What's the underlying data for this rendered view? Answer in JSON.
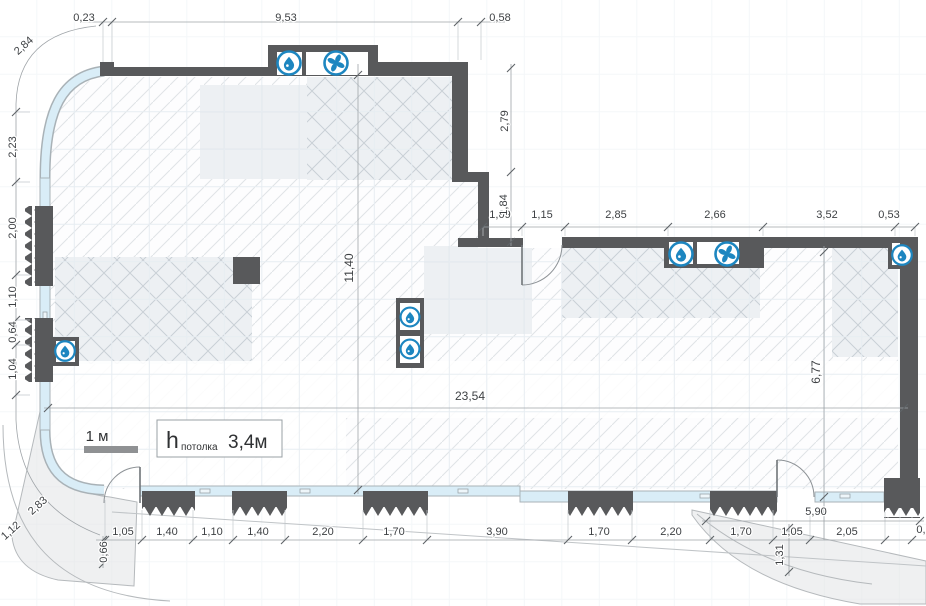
{
  "drawing": {
    "type": "architectural-floor-plan",
    "units": "meters",
    "scale_bar": {
      "label": "1 м"
    },
    "ceiling_height": {
      "symbol": "h",
      "subscript": "потолка",
      "value": "3,4м"
    },
    "colors": {
      "wall": "#58595b",
      "window_glass": "#d9edf7",
      "icon_blue": "#1d86c0",
      "dim_text": "#3e4144"
    },
    "dimensions": {
      "top_chain": [
        "0,23",
        "9,53",
        "0,58"
      ],
      "top_left_arc": "2,84",
      "right_wing_top_chain": [
        "1,09",
        "1,15",
        "2,85",
        "2,66",
        "3,52",
        "0,53"
      ],
      "right_side_verticals": [
        "2,79",
        "1,84"
      ],
      "interior_width": "23,54",
      "interior_height": "11,40",
      "right_wing_depth": "6,77",
      "left_chain": [
        "2,23",
        "2,00",
        "1,10",
        "0,64",
        "1,04"
      ],
      "left_bottom_arc": [
        "2,83",
        "1,12"
      ],
      "bottom_chain": [
        "1,05",
        "1,40",
        "1,10",
        "1,40",
        "2,20",
        "1,70",
        "3,90",
        "1,70",
        "2,20",
        "1,70",
        "1,05",
        "2,05",
        "0,"
      ],
      "bottom_right_overall": "5,90",
      "bottom_left_offset": "0,66",
      "terrace_depth": "1,31"
    },
    "dim_labels": [
      {
        "t": "0,23",
        "x": 84,
        "y": 18
      },
      {
        "t": "9,53",
        "x": 286,
        "y": 18
      },
      {
        "t": "0,58",
        "x": 500,
        "y": 18
      },
      {
        "t": "2,84",
        "x": 24,
        "y": 46,
        "r": -42
      },
      {
        "t": "1,09",
        "x": 500,
        "y": 215
      },
      {
        "t": "1,15",
        "x": 542,
        "y": 215
      },
      {
        "t": "2,85",
        "x": 616,
        "y": 215
      },
      {
        "t": "2,66",
        "x": 715,
        "y": 215
      },
      {
        "t": "3,52",
        "x": 827,
        "y": 215
      },
      {
        "t": "0,53",
        "x": 889,
        "y": 215
      },
      {
        "t": "2,79",
        "x": 505,
        "y": 121,
        "r": -90
      },
      {
        "t": "1,84",
        "x": 504,
        "y": 205,
        "r": -90
      },
      {
        "t": "11,40",
        "x": 350,
        "y": 268,
        "r": -90,
        "s": 12
      },
      {
        "t": "6,77",
        "x": 817,
        "y": 372,
        "r": -90,
        "s": 12
      },
      {
        "t": "23,54",
        "x": 470,
        "y": 397,
        "s": 12
      },
      {
        "t": "2,23",
        "x": 13,
        "y": 147,
        "r": -90
      },
      {
        "t": "2,00",
        "x": 13,
        "y": 228,
        "r": -90
      },
      {
        "t": "1,10",
        "x": 13,
        "y": 297,
        "r": -90
      },
      {
        "t": "0,64",
        "x": 13,
        "y": 332,
        "r": -90
      },
      {
        "t": "1,04",
        "x": 13,
        "y": 369,
        "r": -90
      },
      {
        "t": "2,83",
        "x": 38,
        "y": 506,
        "r": -42
      },
      {
        "t": "1,12",
        "x": 11,
        "y": 531,
        "r": -42
      },
      {
        "t": "1,05",
        "x": 123,
        "y": 532
      },
      {
        "t": "1,40",
        "x": 167,
        "y": 532
      },
      {
        "t": "1,10",
        "x": 212,
        "y": 532
      },
      {
        "t": "1,40",
        "x": 258,
        "y": 532
      },
      {
        "t": "2,20",
        "x": 323,
        "y": 532
      },
      {
        "t": "1,70",
        "x": 394,
        "y": 532
      },
      {
        "t": "3,90",
        "x": 497,
        "y": 532
      },
      {
        "t": "1,70",
        "x": 599,
        "y": 532
      },
      {
        "t": "2,20",
        "x": 671,
        "y": 532
      },
      {
        "t": "1,70",
        "x": 741,
        "y": 532
      },
      {
        "t": "1,05",
        "x": 792,
        "y": 532
      },
      {
        "t": "2,05",
        "x": 847,
        "y": 532
      },
      {
        "t": "0,",
        "x": 921,
        "y": 530
      },
      {
        "t": "5,90",
        "x": 816,
        "y": 512
      },
      {
        "t": "0,66",
        "x": 104,
        "y": 552,
        "r": -90
      },
      {
        "t": "1,31",
        "x": 780,
        "y": 555,
        "r": -90
      }
    ],
    "icons": [
      {
        "type": "drop",
        "x": 289,
        "y": 63
      },
      {
        "type": "fan",
        "x": 336,
        "y": 63
      },
      {
        "type": "drop",
        "x": 681,
        "y": 254
      },
      {
        "type": "fan",
        "x": 727,
        "y": 254
      },
      {
        "type": "drop",
        "x": 902,
        "y": 255,
        "s": 0.85
      },
      {
        "type": "drop",
        "x": 65,
        "y": 351,
        "s": 0.85
      },
      {
        "type": "drop",
        "x": 410,
        "y": 317,
        "s": 0.82
      },
      {
        "type": "drop",
        "x": 410,
        "y": 349,
        "s": 0.82
      }
    ]
  }
}
